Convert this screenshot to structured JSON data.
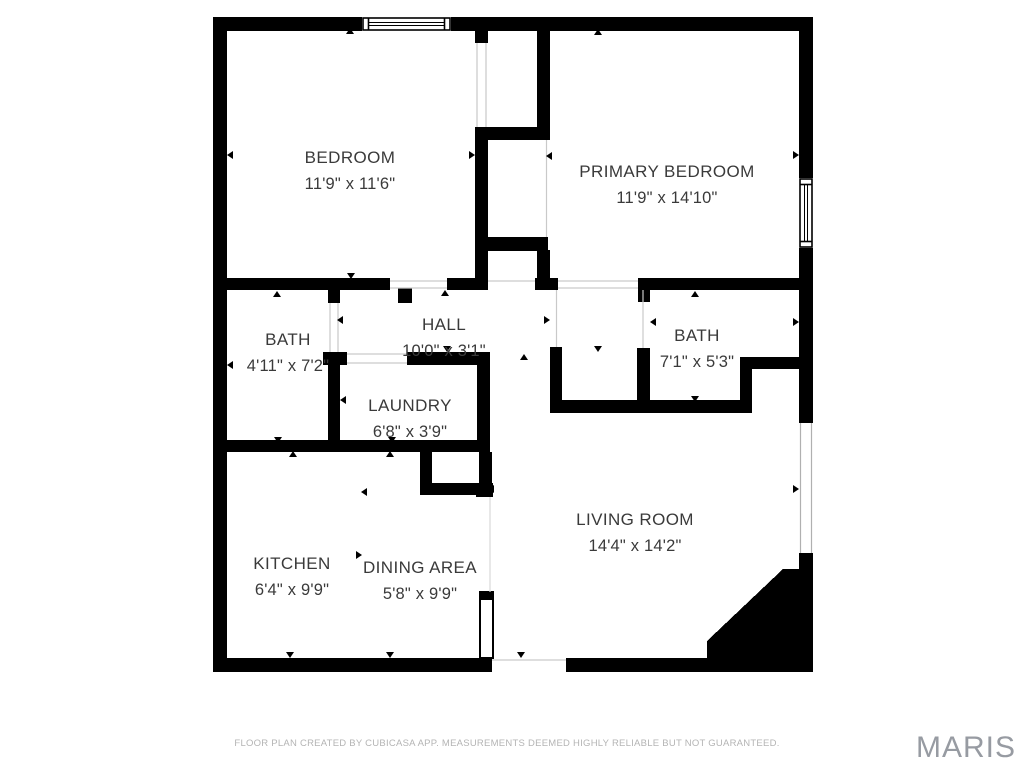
{
  "floor_plan": {
    "rooms": [
      {
        "id": "bedroom",
        "name": "BEDROOM",
        "dimensions": "11'9\" x 11'6\""
      },
      {
        "id": "primary-bedroom",
        "name": "PRIMARY BEDROOM",
        "dimensions": "11'9\" x 14'10\""
      },
      {
        "id": "bath-left",
        "name": "BATH",
        "dimensions": "4'11\" x 7'2\""
      },
      {
        "id": "hall",
        "name": "HALL",
        "dimensions": "10'0\" x 3'1\""
      },
      {
        "id": "bath-right",
        "name": "BATH",
        "dimensions": "7'1\" x 5'3\""
      },
      {
        "id": "laundry",
        "name": "LAUNDRY",
        "dimensions": "6'8\" x 3'9\""
      },
      {
        "id": "kitchen",
        "name": "KITCHEN",
        "dimensions": "6'4\" x 9'9\""
      },
      {
        "id": "dining-area",
        "name": "DINING AREA",
        "dimensions": "5'8\" x 9'9\""
      },
      {
        "id": "living-room",
        "name": "LIVING ROOM",
        "dimensions": "14'4\" x 14'2\""
      }
    ],
    "footer_disclaimer": "FLOOR PLAN CREATED BY CUBICASA APP. MEASUREMENTS DEEMED HIGHLY RELIABLE BUT NOT GUARANTEED.",
    "watermark": "MARIS",
    "colors": {
      "wall": "#000000",
      "background": "#ffffff",
      "room_text": "#3a3a3a",
      "disclaimer_text": "#b4b4b4",
      "watermark_text": "#979ba2",
      "door_line": "#c9c9c9"
    }
  }
}
